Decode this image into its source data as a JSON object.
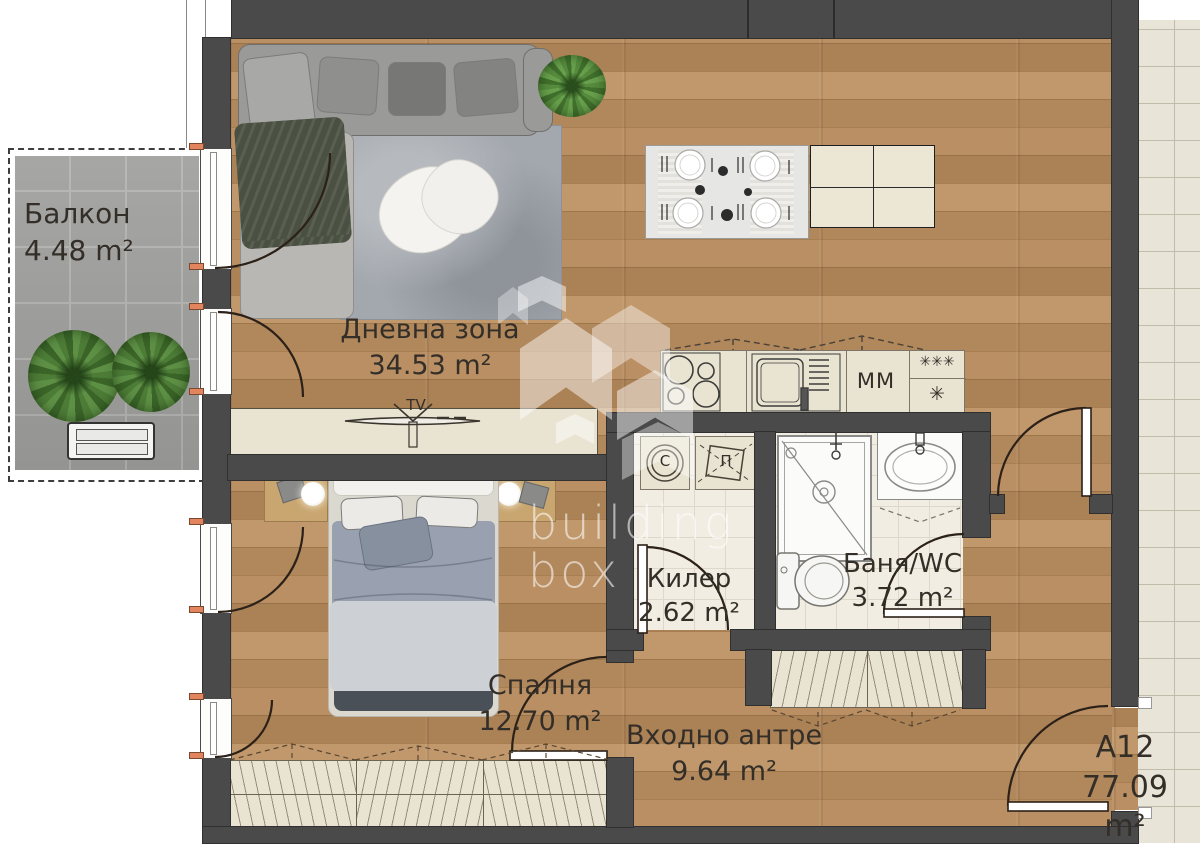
{
  "unit": {
    "id": "A12",
    "area": "77.09 m²"
  },
  "rooms": {
    "balcony": {
      "name": "Балкон",
      "area": "4.48 m²"
    },
    "living": {
      "name": "Дневна зона",
      "area": "34.53 m²"
    },
    "bedroom": {
      "name": "Спалня",
      "area": "12.70 m²"
    },
    "storage": {
      "name": "Килер",
      "area": "2.62 m²"
    },
    "bath": {
      "name": "Баня/WC",
      "area": "3.72 m²"
    },
    "hall": {
      "name": "Входно антре",
      "area": "9.64 m²"
    }
  },
  "labels": {
    "tv": "TV",
    "dishwasher": "ММ",
    "freezer_stars": "✳✳✳",
    "freezer_star": "✳",
    "dryer": "С",
    "washer": "П"
  },
  "watermark": {
    "line1": "building",
    "line2": "box"
  },
  "colors": {
    "wall": "#4a4a4a",
    "wood": "#ac8257",
    "accent_marker": "#e2855f",
    "cabinet": "#e9e3d1",
    "balcony_tile": "#9c9c9a",
    "bath_tile": "#f1ede3",
    "corridor_tile": "#e9e4d8"
  }
}
